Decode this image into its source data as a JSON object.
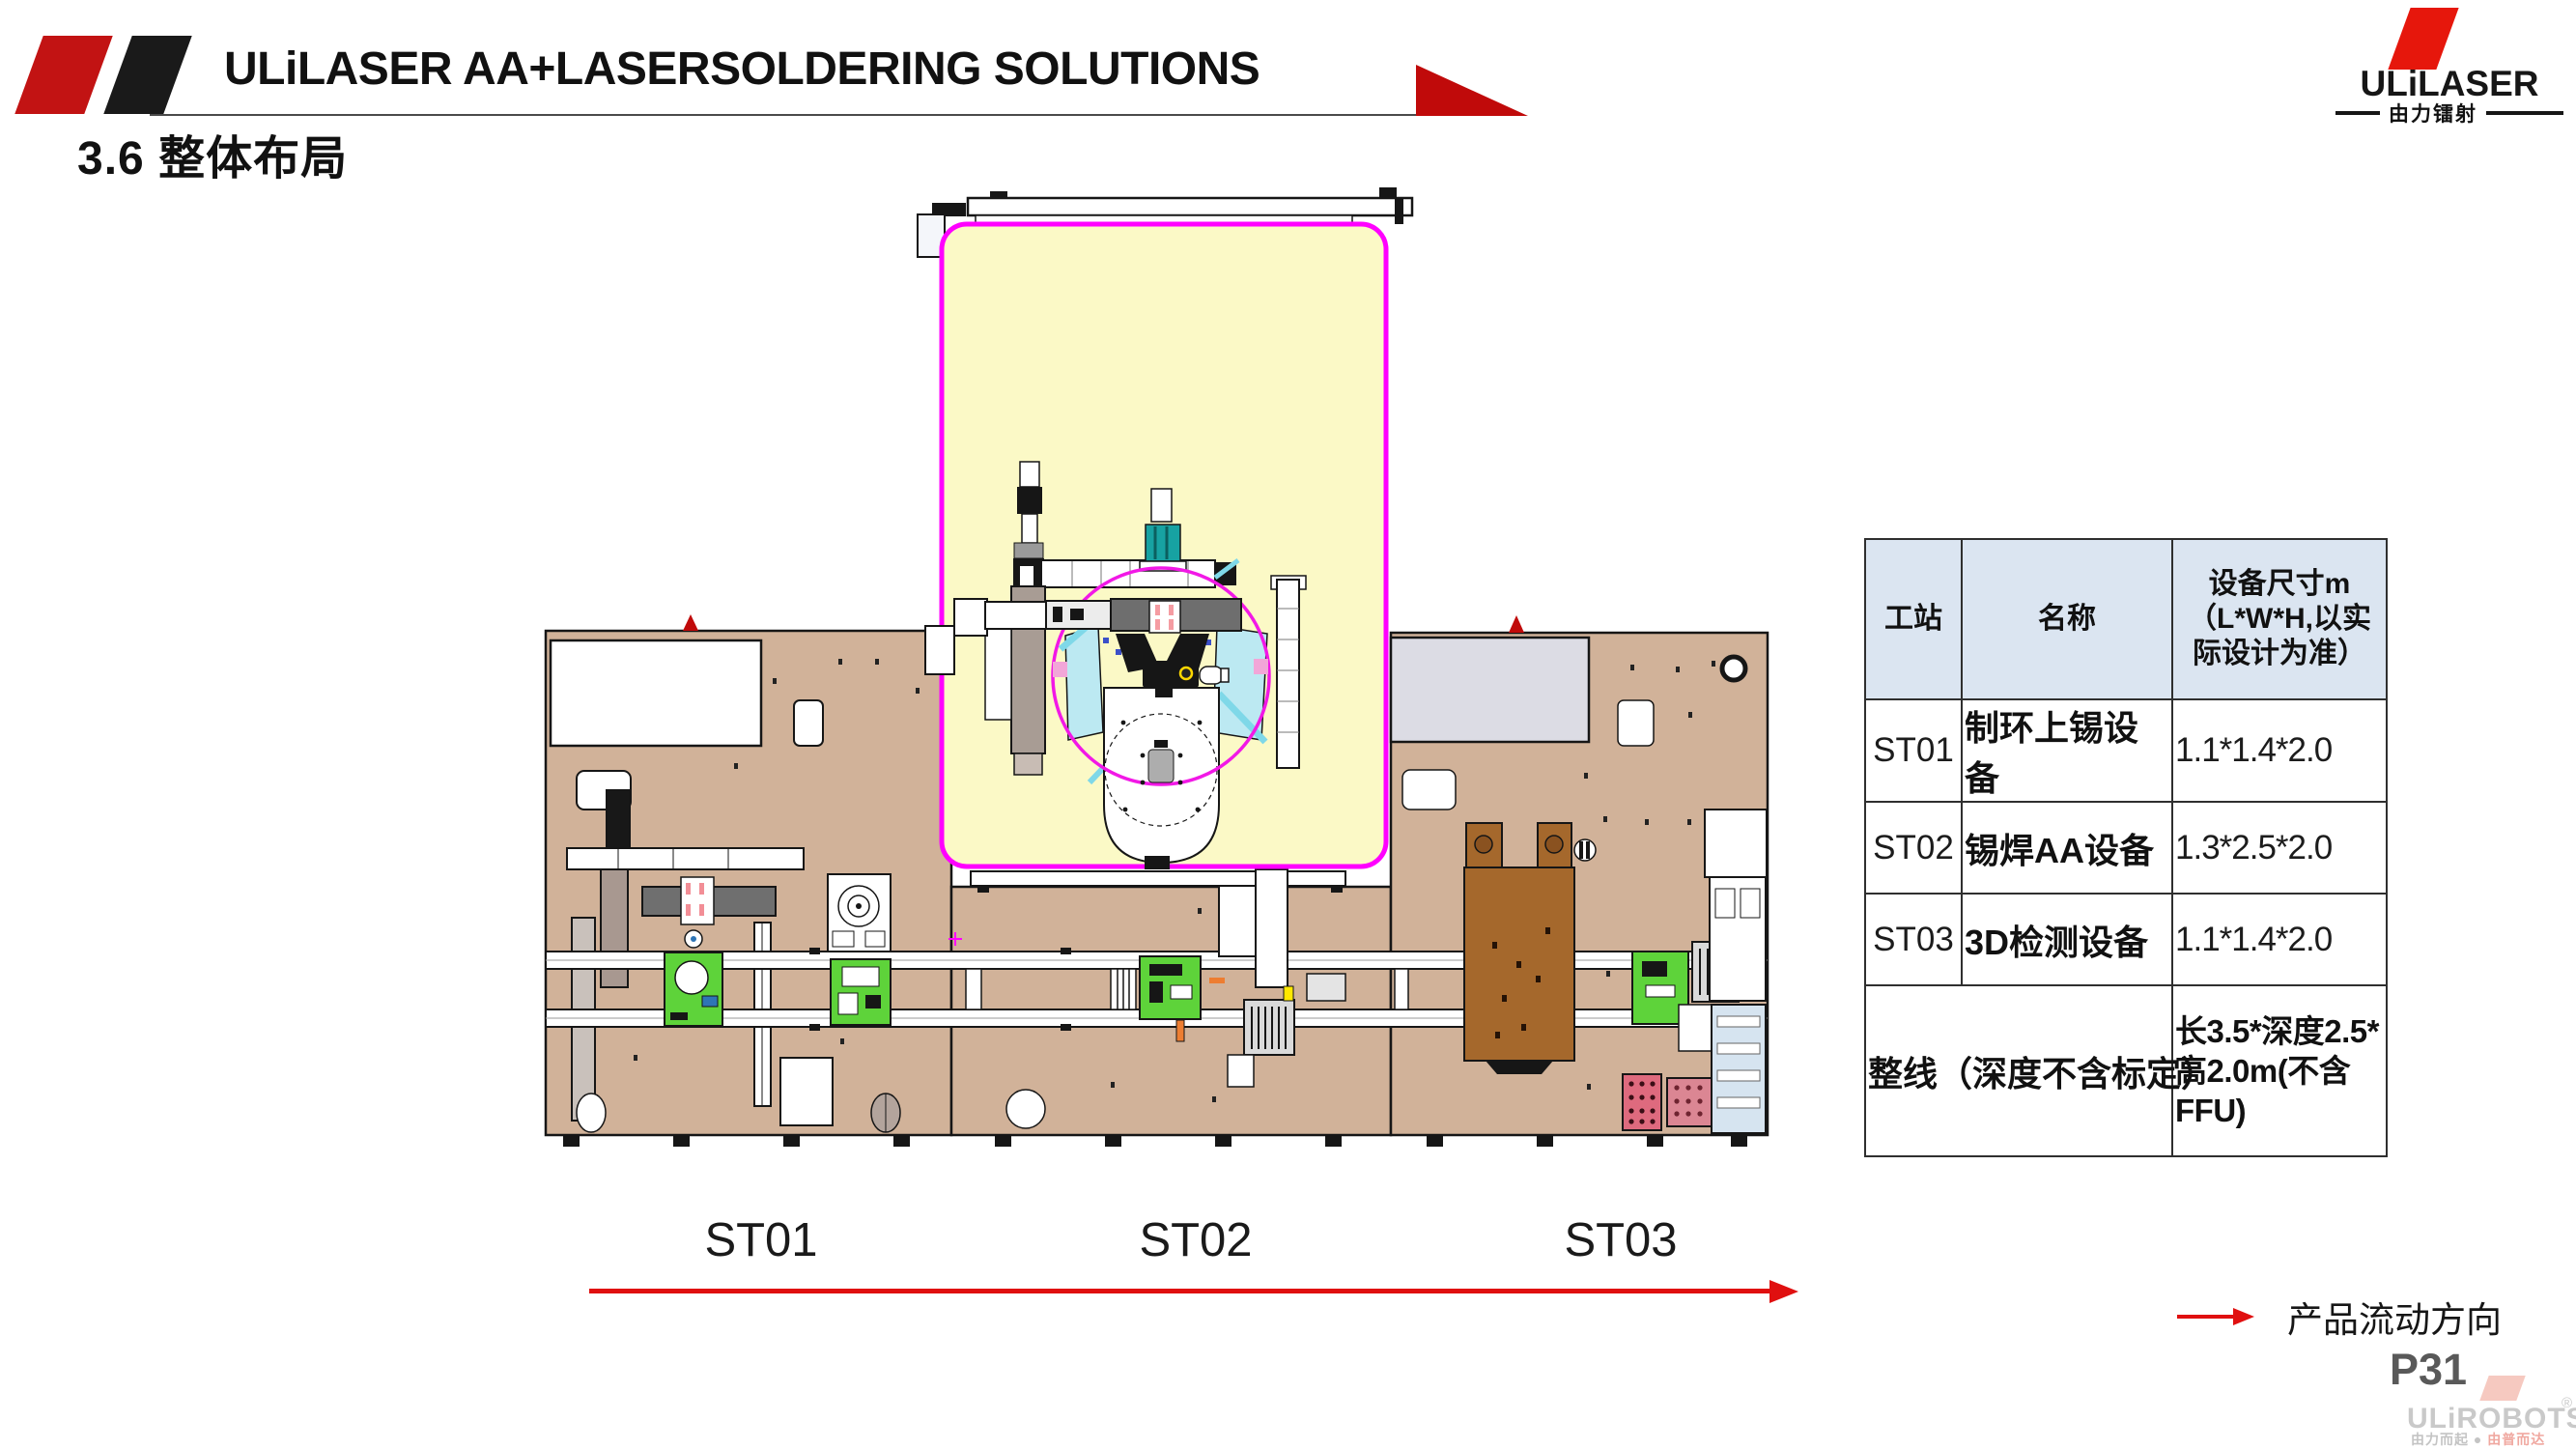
{
  "header": {
    "title": "ULiLASER AA+LASERSOLDERING SOLUTIONS",
    "section_title": "3.6 整体布局"
  },
  "logo": {
    "brand": "ULiLASER",
    "subtitle": "由力镭射"
  },
  "table": {
    "columns": [
      "工站",
      "名称",
      "设备尺寸m（L*W*H,以实际设计为准）"
    ],
    "rows": [
      {
        "station": "ST01",
        "name": "制环上锡设备",
        "size": "1.1*1.4*2.0"
      },
      {
        "station": "ST02",
        "name": "锡焊AA设备",
        "size": "1.3*2.5*2.0"
      },
      {
        "station": "ST03",
        "name": "3D检测设备",
        "size": "1.1*1.4*2.0"
      }
    ],
    "footer": {
      "label": "整线（深度不含标定）",
      "size": "长3.5*深度2.5*高2.0m(不含FFU)"
    }
  },
  "stations": [
    {
      "label": "ST01"
    },
    {
      "label": "ST02"
    },
    {
      "label": "ST03"
    }
  ],
  "legend": {
    "flow_label": "产品流动方向"
  },
  "page_number": "P31",
  "watermark": {
    "brand": "ULiROBOTS",
    "reg": "®",
    "tagline_left": "由力而起",
    "tagline_dot": "●",
    "tagline_right": "由普而达"
  },
  "diagram": {
    "colors": {
      "bed_tan": "#D1B299",
      "room_yellow": "#FBF9C6",
      "room_border_magenta": "#FF00FF",
      "carrier_green": "#5ED33A",
      "fixture_brown": "#A5682C",
      "panel_cyan": "#BCE9F2",
      "accent_red": "#C00A0A"
    }
  }
}
